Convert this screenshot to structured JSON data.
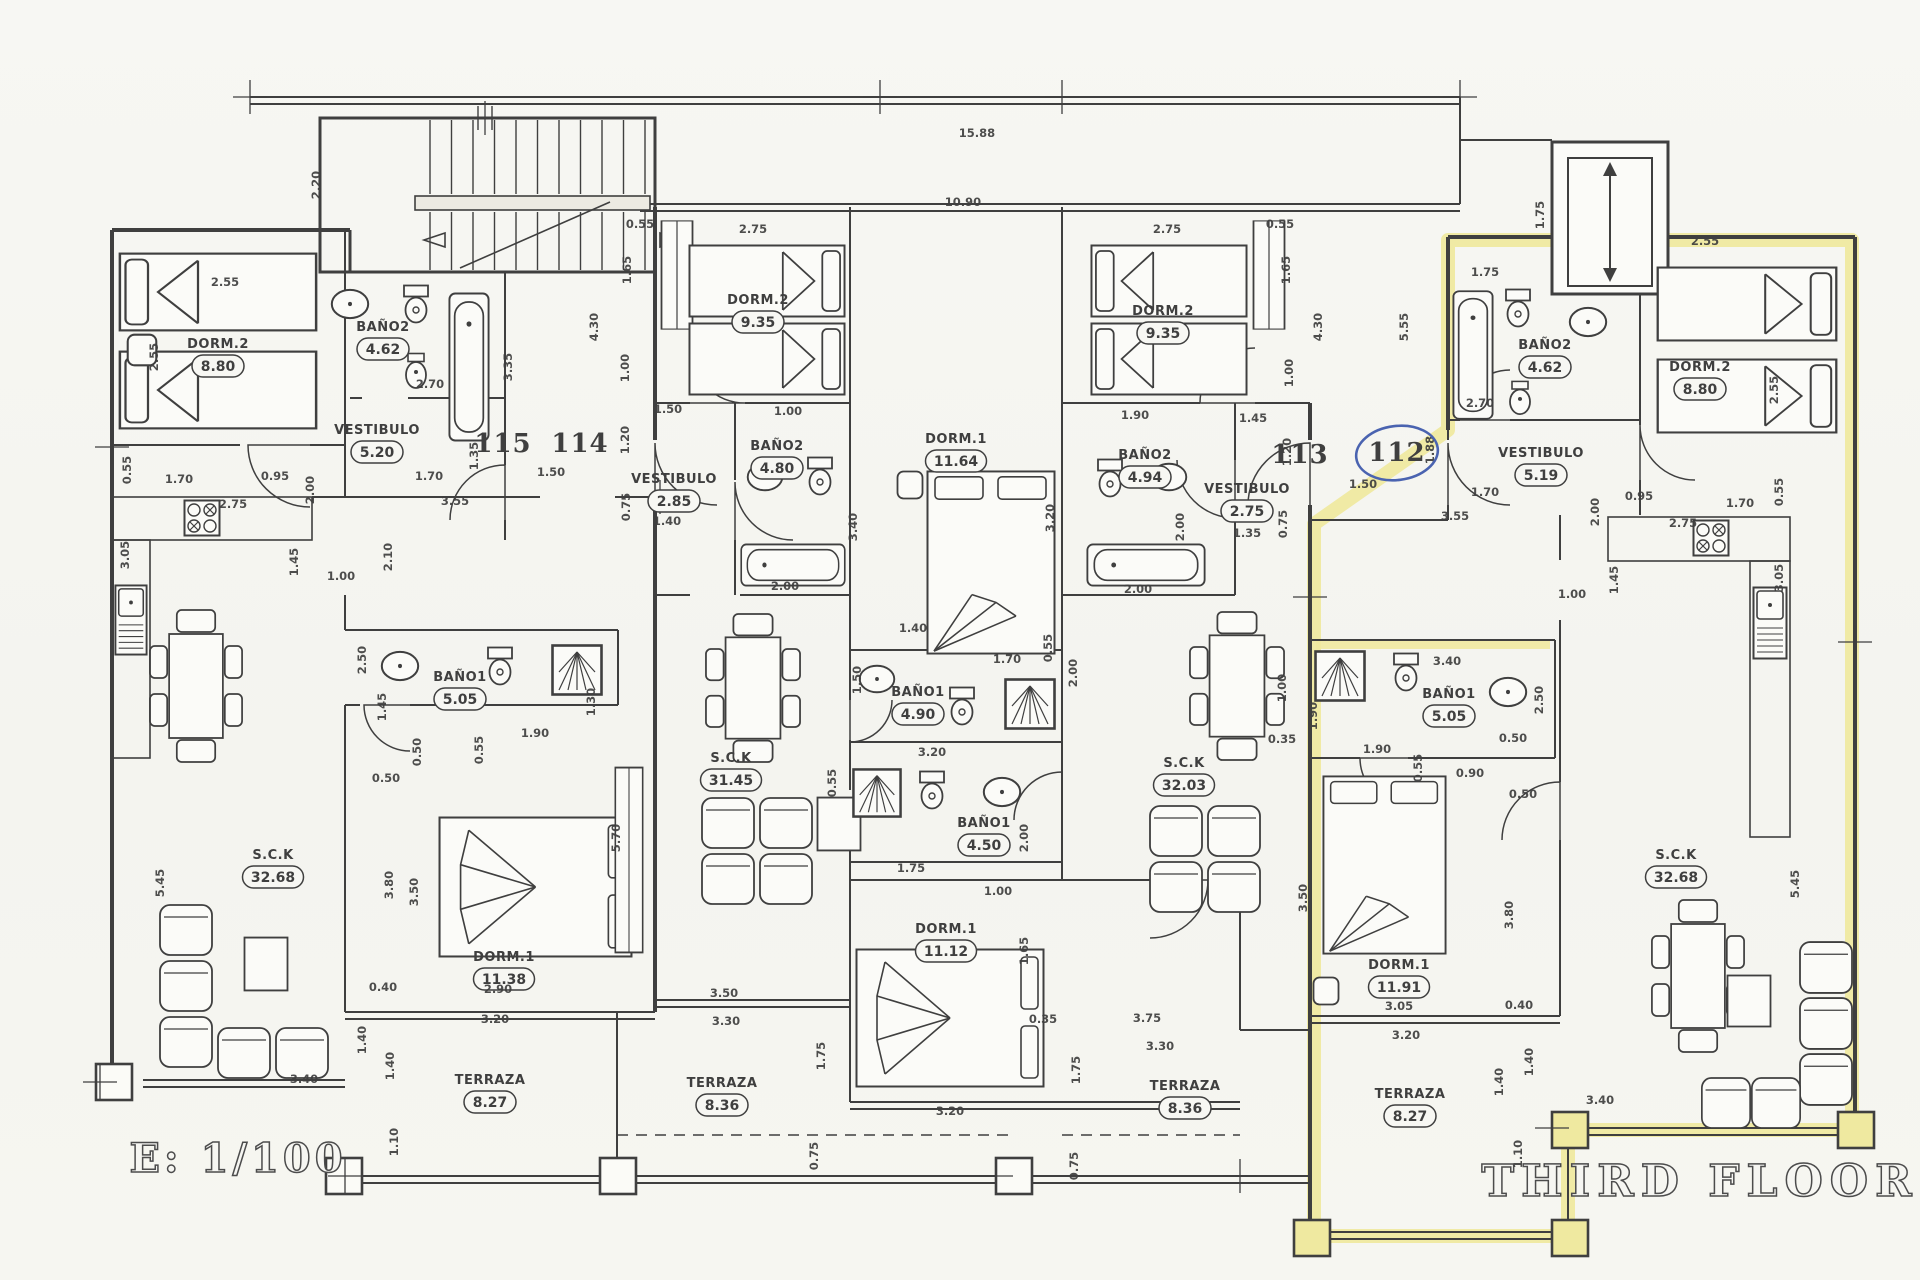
{
  "title": "THIRD FLOOR",
  "scale_label": "E: 1/100",
  "colors": {
    "ink": "#3f3f3f",
    "highlight": "#efe9a0",
    "pen_circle": "#4a63b0",
    "paper": "#f6f6f2"
  },
  "units": [
    {
      "text": "115",
      "x": 503,
      "y": 452,
      "circled": false
    },
    {
      "text": "114",
      "x": 580,
      "y": 452,
      "circled": false
    },
    {
      "text": "113",
      "x": 1300,
      "y": 463,
      "circled": false
    },
    {
      "text": "112",
      "x": 1397,
      "y": 461,
      "circled": true
    }
  ],
  "rooms": [
    [
      "DORM.2",
      "8.80",
      218,
      348
    ],
    [
      "BAÑO2",
      "4.62",
      383,
      331
    ],
    [
      "VESTIBULO",
      "5.20",
      377,
      434
    ],
    [
      "BAÑO1",
      "5.05",
      460,
      681
    ],
    [
      "DORM.1",
      "11.38",
      504,
      961
    ],
    [
      "S.C.K",
      "32.68",
      273,
      859
    ],
    [
      "TERRAZA",
      "8.27",
      490,
      1084
    ],
    [
      "DORM.2",
      "9.35",
      758,
      304
    ],
    [
      "BAÑO2",
      "4.80",
      777,
      450
    ],
    [
      "VESTIBULO",
      "2.85",
      674,
      483
    ],
    [
      "DORM.1",
      "11.64",
      956,
      443
    ],
    [
      "BAÑO1",
      "4.90",
      918,
      696
    ],
    [
      "S.C.K",
      "31.45",
      731,
      762
    ],
    [
      "BAÑO1",
      "4.50",
      984,
      827
    ],
    [
      "DORM.1",
      "11.12",
      946,
      933
    ],
    [
      "TERRAZA",
      "8.36",
      722,
      1087
    ],
    [
      "DORM.2",
      "9.35",
      1163,
      315
    ],
    [
      "BAÑO2",
      "4.94",
      1145,
      459
    ],
    [
      "VESTIBULO",
      "2.75",
      1247,
      493
    ],
    [
      "S.C.K",
      "32.03",
      1184,
      767
    ],
    [
      "TERRAZA",
      "8.36",
      1185,
      1090
    ],
    [
      "BAÑO1",
      "5.05",
      1449,
      698
    ],
    [
      "DORM.1",
      "11.91",
      1399,
      969
    ],
    [
      "TERRAZA",
      "8.27",
      1410,
      1098
    ],
    [
      "VESTIBULO",
      "5.19",
      1541,
      457
    ],
    [
      "BAÑO2",
      "4.62",
      1545,
      349
    ],
    [
      "DORM.2",
      "8.80",
      1700,
      371
    ],
    [
      "S.C.K",
      "32.68",
      1676,
      859
    ]
  ],
  "dims": [
    [
      "15.88",
      977,
      137,
      0
    ],
    [
      "10.90",
      963,
      206,
      0
    ],
    [
      "2.20",
      320,
      185,
      90
    ],
    [
      "2.55",
      225,
      286,
      0
    ],
    [
      "2.55",
      158,
      357,
      90
    ],
    [
      "3.35",
      512,
      367,
      90
    ],
    [
      "2.70",
      430,
      388,
      0
    ],
    [
      "0.55",
      131,
      470,
      90
    ],
    [
      "1.70",
      179,
      483,
      0
    ],
    [
      "0.95",
      275,
      480,
      0
    ],
    [
      "2.00",
      314,
      490,
      90
    ],
    [
      "2.75",
      233,
      508,
      0
    ],
    [
      "3.05",
      129,
      555,
      90
    ],
    [
      "1.45",
      298,
      562,
      90
    ],
    [
      "1.00",
      341,
      580,
      0
    ],
    [
      "1.35",
      478,
      456,
      90
    ],
    [
      "1.70",
      429,
      480,
      0
    ],
    [
      "1.50",
      551,
      476,
      0
    ],
    [
      "3.55",
      455,
      505,
      0
    ],
    [
      "0.75",
      630,
      507,
      90
    ],
    [
      "1.40",
      667,
      525,
      0
    ],
    [
      "2.10",
      392,
      557,
      90
    ],
    [
      "2.50",
      366,
      660,
      90
    ],
    [
      "1.45",
      386,
      707,
      90
    ],
    [
      "0.50",
      421,
      752,
      90
    ],
    [
      "0.50",
      386,
      782,
      0
    ],
    [
      "1.90",
      535,
      737,
      0
    ],
    [
      "0.55",
      483,
      750,
      90
    ],
    [
      "1.30",
      595,
      702,
      90
    ],
    [
      "3.80",
      393,
      885,
      90
    ],
    [
      "3.50",
      418,
      892,
      90
    ],
    [
      "5.70",
      620,
      838,
      90
    ],
    [
      "0.40",
      383,
      991,
      0
    ],
    [
      "2.90",
      498,
      993,
      0
    ],
    [
      "5.45",
      164,
      883,
      90
    ],
    [
      "3.40",
      304,
      1083,
      0
    ],
    [
      "1.40",
      366,
      1040,
      90
    ],
    [
      "1.40",
      394,
      1066,
      90
    ],
    [
      "1.10",
      398,
      1142,
      90
    ],
    [
      "3.20",
      495,
      1023,
      0
    ],
    [
      "0.55",
      640,
      228,
      0
    ],
    [
      "2.75",
      753,
      233,
      0
    ],
    [
      "1.65",
      631,
      270,
      90
    ],
    [
      "4.30",
      598,
      327,
      90
    ],
    [
      "1.00",
      629,
      368,
      90
    ],
    [
      "1.50",
      668,
      413,
      0
    ],
    [
      "1.00",
      788,
      415,
      0
    ],
    [
      "1.20",
      629,
      440,
      90
    ],
    [
      "2.75",
      1167,
      233,
      0
    ],
    [
      "0.55",
      1280,
      228,
      0
    ],
    [
      "1.65",
      1290,
      270,
      90
    ],
    [
      "4.30",
      1322,
      327,
      90
    ],
    [
      "1.00",
      1293,
      373,
      90
    ],
    [
      "1.90",
      1135,
      419,
      0
    ],
    [
      "1.45",
      1253,
      422,
      0
    ],
    [
      "1.20",
      1291,
      452,
      90
    ],
    [
      "1.35",
      1247,
      537,
      0
    ],
    [
      "2.00",
      785,
      590,
      0
    ],
    [
      "3.40",
      857,
      527,
      90
    ],
    [
      "2.00",
      1138,
      593,
      0
    ],
    [
      "3.20",
      1054,
      518,
      90
    ],
    [
      "2.00",
      1184,
      527,
      90
    ],
    [
      "0.75",
      1287,
      524,
      90
    ],
    [
      "1.40",
      913,
      632,
      0
    ],
    [
      "1.50",
      861,
      680,
      90
    ],
    [
      "1.70",
      1007,
      663,
      0
    ],
    [
      "0.55",
      1052,
      648,
      90
    ],
    [
      "2.00",
      1077,
      673,
      90
    ],
    [
      "3.20",
      932,
      756,
      0
    ],
    [
      "0.55",
      836,
      783,
      90
    ],
    [
      "1.75",
      911,
      872,
      0
    ],
    [
      "1.00",
      998,
      895,
      0
    ],
    [
      "2.00",
      1028,
      838,
      90
    ],
    [
      "3.50",
      724,
      997,
      0
    ],
    [
      "3.30",
      726,
      1025,
      0
    ],
    [
      "1.75",
      825,
      1056,
      90
    ],
    [
      "3.20",
      950,
      1115,
      0
    ],
    [
      "0.75",
      818,
      1156,
      90
    ],
    [
      "1.65",
      1028,
      951,
      90
    ],
    [
      "0.35",
      1043,
      1023,
      0
    ],
    [
      "1.75",
      1080,
      1070,
      90
    ],
    [
      "0.75",
      1078,
      1166,
      90
    ],
    [
      "3.75",
      1147,
      1022,
      0
    ],
    [
      "3.30",
      1160,
      1050,
      0
    ],
    [
      "1.75",
      1544,
      215,
      90
    ],
    [
      "1.75",
      1485,
      276,
      0
    ],
    [
      "5.55",
      1408,
      327,
      90
    ],
    [
      "2.55",
      1705,
      245,
      0
    ],
    [
      "2.55",
      1778,
      390,
      90
    ],
    [
      "2.70",
      1480,
      407,
      0
    ],
    [
      "1.88",
      1434,
      450,
      90
    ],
    [
      "1.50",
      1363,
      488,
      0
    ],
    [
      "1.70",
      1485,
      496,
      0
    ],
    [
      "0.95",
      1639,
      500,
      0
    ],
    [
      "1.70",
      1740,
      507,
      0
    ],
    [
      "0.55",
      1783,
      492,
      90
    ],
    [
      "2.00",
      1599,
      512,
      90
    ],
    [
      "2.75",
      1683,
      527,
      0
    ],
    [
      "3.55",
      1455,
      520,
      0
    ],
    [
      "1.45",
      1618,
      580,
      90
    ],
    [
      "1.00",
      1572,
      598,
      0
    ],
    [
      "3.05",
      1783,
      578,
      90
    ],
    [
      "3.40",
      1447,
      665,
      0
    ],
    [
      "1.00",
      1286,
      688,
      90
    ],
    [
      "1.90",
      1317,
      716,
      90
    ],
    [
      "0.35",
      1282,
      743,
      0
    ],
    [
      "1.90",
      1377,
      753,
      0
    ],
    [
      "0.55",
      1422,
      768,
      90
    ],
    [
      "0.90",
      1470,
      777,
      0
    ],
    [
      "0.50",
      1513,
      742,
      0
    ],
    [
      "0.50",
      1523,
      798,
      0
    ],
    [
      "2.50",
      1543,
      700,
      90
    ],
    [
      "3.50",
      1307,
      898,
      90
    ],
    [
      "3.80",
      1513,
      915,
      90
    ],
    [
      "3.05",
      1399,
      1010,
      0
    ],
    [
      "0.40",
      1519,
      1009,
      0
    ],
    [
      "3.20",
      1406,
      1039,
      0
    ],
    [
      "1.40",
      1533,
      1062,
      90
    ],
    [
      "1.40",
      1503,
      1082,
      90
    ],
    [
      "3.40",
      1600,
      1104,
      0
    ],
    [
      "1.10",
      1522,
      1154,
      90
    ],
    [
      "5.45",
      1799,
      884,
      90
    ]
  ]
}
